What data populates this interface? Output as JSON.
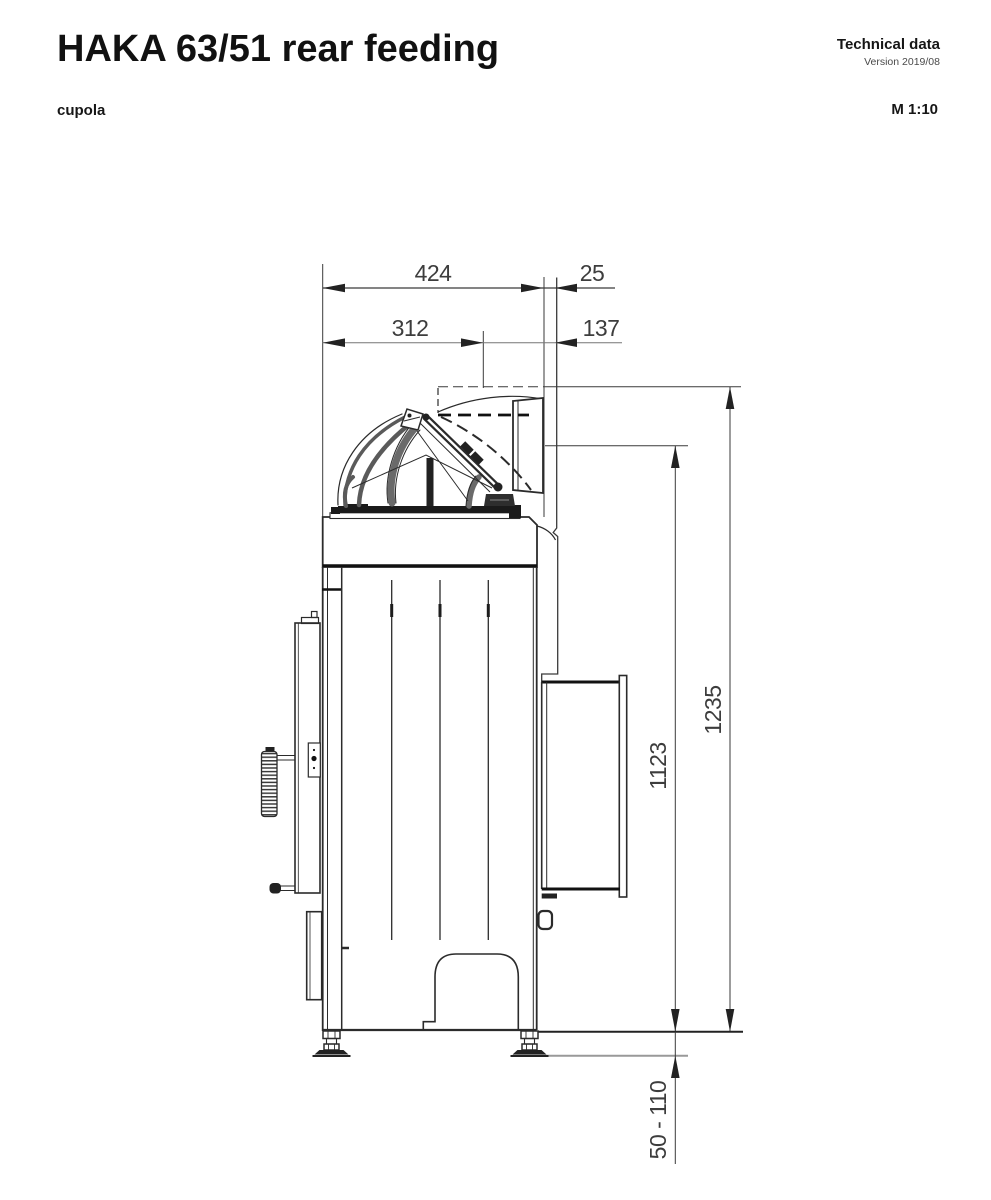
{
  "header": {
    "title": "HAKA 63/51 rear feeding",
    "doc_type": "Technical data",
    "version": "Version 2019/08",
    "view_label": "cupola",
    "scale_label": "M 1:10"
  },
  "dims": {
    "depth_total": "424",
    "wall_gap": "25",
    "depth_front": "312",
    "depth_rear": "137",
    "feed_height": "1123",
    "total_height": "1235",
    "foot_range": "50 - 110"
  },
  "drawing": {
    "description": "Side view technical drawing of HAKA 63/51 baler with rear feeding cupola, dimensions in mm",
    "line_color": "#2b2b2b",
    "dim_color": "#3d3d3d"
  }
}
